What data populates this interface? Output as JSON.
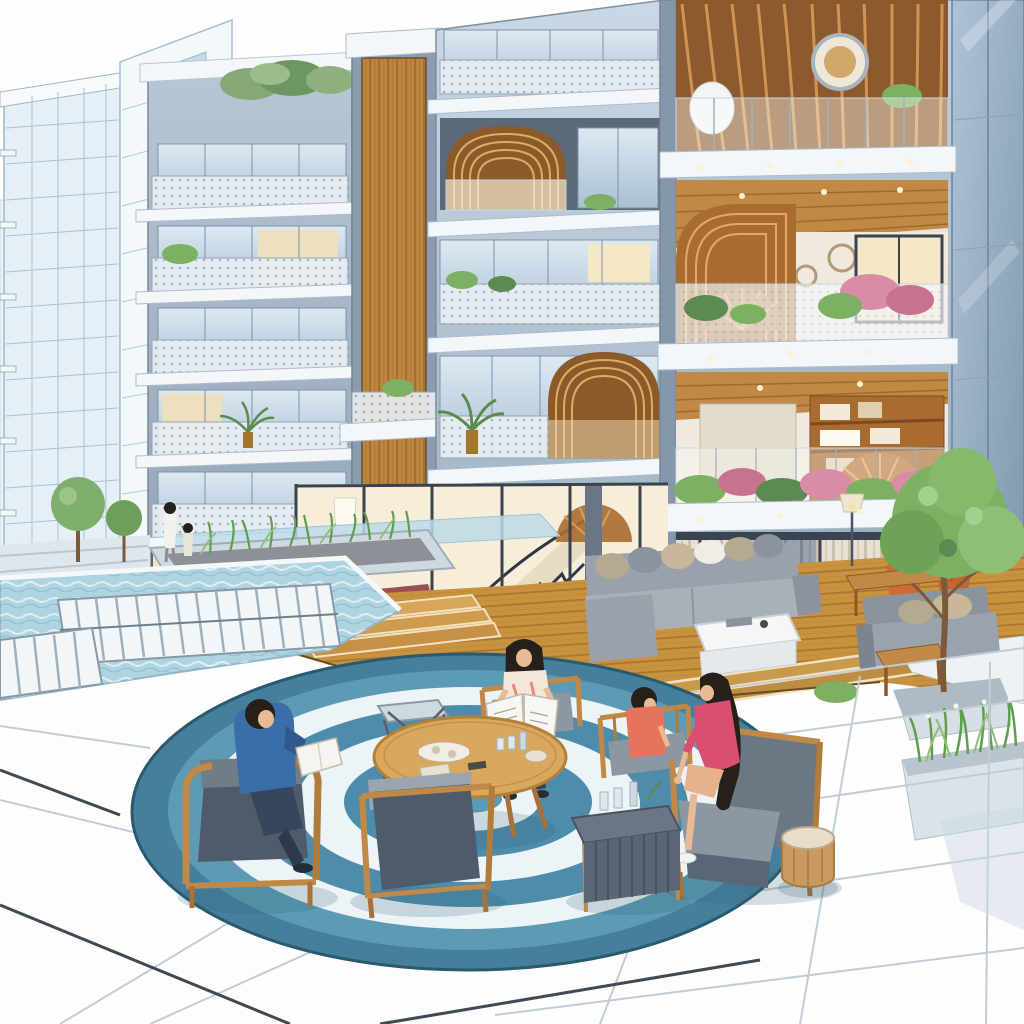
{
  "scene": {
    "title": "Modern apartment courtyard rendering",
    "description": "Architectural illustration of a multi-storey apartment building with glass facades, wood-lined arched balconies, flower planters and visible furnished interiors, above a courtyard with a swimming pool, a slatted footbridge, a raised wooden deck furnished as an outdoor living room, and a circular blue concentric rug with wooden armchairs where residents sit reading.",
    "people": [
      {
        "name": "boy-reading",
        "description": "boy in a blue t-shirt reading in a wood-frame armchair"
      },
      {
        "name": "woman-newspaper",
        "description": "woman reading an open newspaper beside the round table"
      },
      {
        "name": "girl-coral",
        "description": "girl in a coral top seated in an armchair"
      },
      {
        "name": "woman-pink",
        "description": "woman in a pink top with long dark hair seated leaning forward"
      },
      {
        "name": "figures-by-pool",
        "description": "adult and child standing by the pool planters"
      }
    ],
    "objects": [
      "background high-rise towers (sketch style)",
      "balcony lattice railings",
      "glass railings",
      "arched wood-rib balcony ceilings",
      "rooftop shrubs",
      "balcony flower boxes with pink blooms",
      "porthole mirror",
      "bookshelf interior",
      "spiral wood fan decor",
      "ground-floor bedroom with maroon bedding",
      "spiral staircase",
      "dining set",
      "beige curtains",
      "gray sectional sofa with pillows",
      "white coffee table",
      "orange lounge chairs",
      "floor lamp",
      "gray loveseat",
      "wooden side tables",
      "swimming pool",
      "white slatted footbridge",
      "stone planter with grasses",
      "topiary trees",
      "round wooden coffee table with trays and glasses",
      "metal side table",
      "dark slatted side table",
      "wood-frame armchairs with gray cushions",
      "tan drum stool",
      "teal tote bag",
      "tiled plaza with grid joints",
      "tree in planter",
      "ornamental grass planter",
      "circular rug with concentric blue and white rings"
    ]
  },
  "palette": {
    "sky": "#fdfdfe",
    "pool_water": "#aed4e2",
    "deck_wood": "#c9923f",
    "wood_amber": "#c0853f",
    "rug_edge": "#2a5a6e",
    "rug_deep": "#467f9b",
    "rug_mid": "#5d9ab4",
    "rug_blue": "#4e8cab",
    "rug_white": "#edf4f7",
    "plant_green": "#7cb062",
    "grass_green": "#5f9e4f",
    "flower_pink": "#d88ca6",
    "sofa_gray": "#9aa1aa",
    "cushion_dark": "#4e5b6b",
    "cushion_gray": "#8d97a2",
    "chair_wood": "#c08948",
    "accent_orange": "#cd6b33",
    "stool_tan": "#c89a62",
    "shirt_blue": "#3a6ea8",
    "top_coral": "#e8735c",
    "top_magenta": "#d94f72",
    "skin": "#e9bb95",
    "hair_dark": "#261f1a",
    "blanket_maroon": "#9c4f52",
    "slab_white": "#f3f7fa",
    "tile_line": "#c3ccd4",
    "tile_dark": "#3f4a55",
    "bag_teal": "#4a7d9e"
  }
}
